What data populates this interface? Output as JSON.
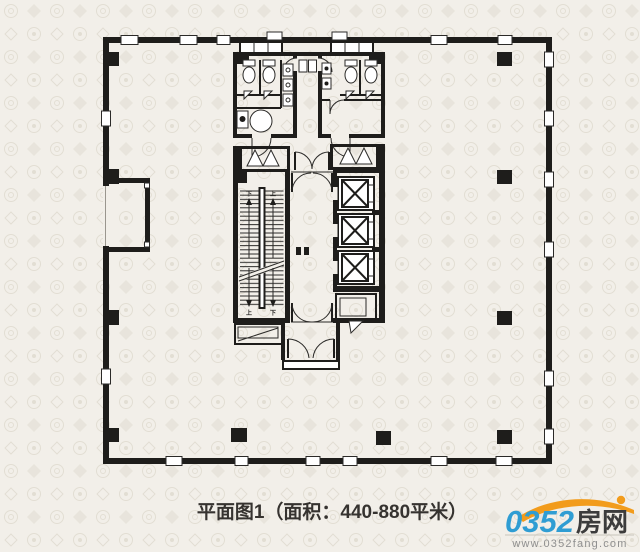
{
  "colors": {
    "bg": "#f2efe9",
    "motif": "#ddd8cc",
    "wall": "#1e1d1b",
    "ink": "#2b2a28",
    "paper": "#ffffff",
    "caption_color": "#363330",
    "logo_blue": "#2f9dd3",
    "logo_orange": "#f29c1c",
    "logo_dark": "#3c3c3c",
    "logo_gray": "#8f8f8f",
    "rule": "#c8c4bb"
  },
  "caption": {
    "text": "平面图1（面积：440-880平米）"
  },
  "plan": {
    "stairs": {
      "up_label": "上",
      "down_label": "下"
    },
    "elevator_count": "3"
  },
  "logo": {
    "number": "0352",
    "name": "房网",
    "url": "www.0352fang.com"
  }
}
